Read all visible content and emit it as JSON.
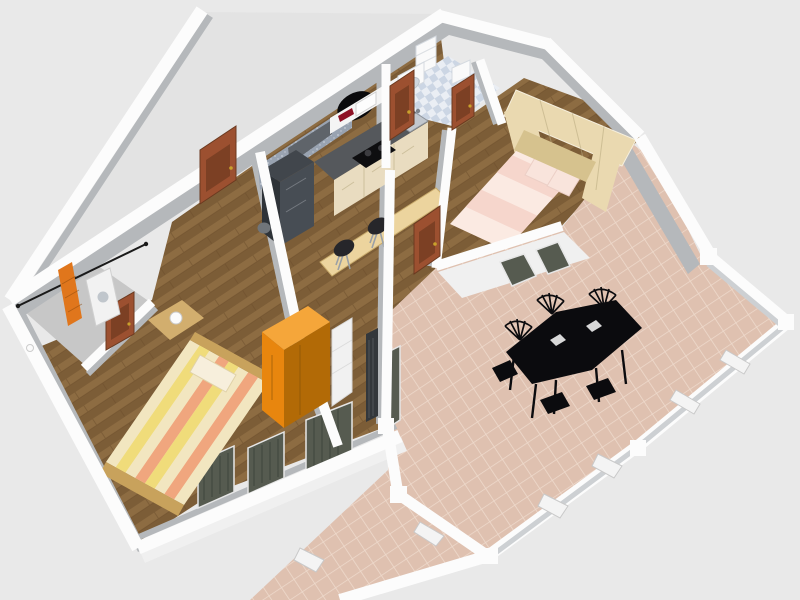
{
  "scene": {
    "title": "3D aerial render of an apartment floor plan",
    "canvas": {
      "width": 800,
      "height": 600
    },
    "view": "isometric-perspective, no visible text or UI chrome"
  },
  "palette": {
    "bg": "#e9e9e9",
    "emptyFloor": "#e3e3e3",
    "wallTop": "#fcfcfc",
    "wallFace": "#b5b8bb",
    "wallFaceLight": "#cdd0d3",
    "faceSunlit": "#f0f0f0",
    "balconyFloor": "#c7c7c7",
    "parquetBase": "#8d6c42",
    "parquetAlt": "#7c5d37",
    "parquetSeam": "#6b4e2c",
    "tileBase": "#dfc1b0",
    "tileGrout": "#eedacc",
    "checkerLight": "#eaeef4",
    "checkerDark": "#ccd6e4",
    "speckBase": "#99a3b1",
    "speckDot": "#c6ccd6",
    "door": "#9c5030",
    "doorPanel": "#7c4024",
    "knob": "#c9a12c",
    "fridgeTop": "#41464c",
    "fridgeFront": "#2e3338",
    "fridgeSide": "#474d54",
    "counter": "#55585c",
    "cabinet": "#e9dcc0",
    "cooktop": "#0e0e10",
    "burner": "#3c3c40",
    "sinkSteel": "#c2c7cd",
    "shelf": "#f4f4f4",
    "microwave": "#fdfdfd",
    "wineRed": "#8e1226",
    "hood": "#5f646a",
    "bar": "#ecd49e",
    "stool": "#26262a",
    "stoolLeg": "#9aa0a6",
    "trash": "#70757a",
    "rug": "#0a0a0c",
    "wardrobeOrangeTop": "#f5a63a",
    "wardrobeOrangeFront": "#e8860e",
    "wardrobeOrangeSide": "#b26a06",
    "shelfUnit": "#f1f1f1",
    "bedFrame": "#c8a25c",
    "stripeCream": "#f2e6c0",
    "stripeSalmon": "#f0a67e",
    "stripeYellow": "#f0dc7a",
    "pillow": "#f7efdc",
    "nightstand": "#d2ae6e",
    "lamp": "#fbfbfb",
    "wardrobeCream": "#ead9b0",
    "wardrobeCreamShade": "#d6c28e",
    "bed2A": "#fbeae2",
    "bed2B": "#f6d6cc",
    "pillowPink": "#f9e4dc",
    "fixtureWhite": "#fafafa",
    "fixtureShade": "#cfd6de",
    "table": "#0b0b0e",
    "radiator": "#33373b",
    "windowGlass": "#565b50",
    "windowFrame": "#e6e6e6",
    "parapetBox": "#f4f4f4",
    "boxLine": "#c9c9c9",
    "line": "#1a1a1a",
    "ladder": "#e0761c",
    "washer": "#f2f2f2",
    "washerDoor": "#c0c6cc"
  },
  "rooms": [
    {
      "id": "balcony-laundry",
      "floor": "gray"
    },
    {
      "id": "bedroom-1",
      "floor": "parquet"
    },
    {
      "id": "kitchen-living-hall",
      "floor": "parquet"
    },
    {
      "id": "bathroom",
      "floor": "blue-white-checker"
    },
    {
      "id": "bedroom-2",
      "floor": "parquet"
    },
    {
      "id": "terrace",
      "floor": "pink-tile"
    },
    {
      "id": "unfurnished-room",
      "floor": "default-gray"
    }
  ],
  "furniture": [
    "clothes-line",
    "step-ladder",
    "washing-machine",
    "striped-double-bed",
    "nightstand-with-lamp",
    "orange-wardrobe",
    "white-shelf-unit",
    "kitchen-fridge-column",
    "kitchen-cabinets-with-cooktop-and-sink",
    "wall-shelf-with-bottles",
    "microwave",
    "extractor-hood",
    "bar-counter",
    "bar-stool",
    "bar-stool",
    "trash-bin",
    "black-oval-rug",
    "interior-door",
    "interior-door",
    "interior-door",
    "interior-door",
    "interior-door",
    "bathroom-tall-cabinet",
    "bathroom-sink",
    "toilet",
    "bridge-wardrobe-cream",
    "pink-double-bed",
    "radiator",
    "curtained-window",
    "curtained-window",
    "glass-door",
    "dining-table-black",
    "dining-chair-black-x6",
    "parapet-planter-box-x6"
  ]
}
